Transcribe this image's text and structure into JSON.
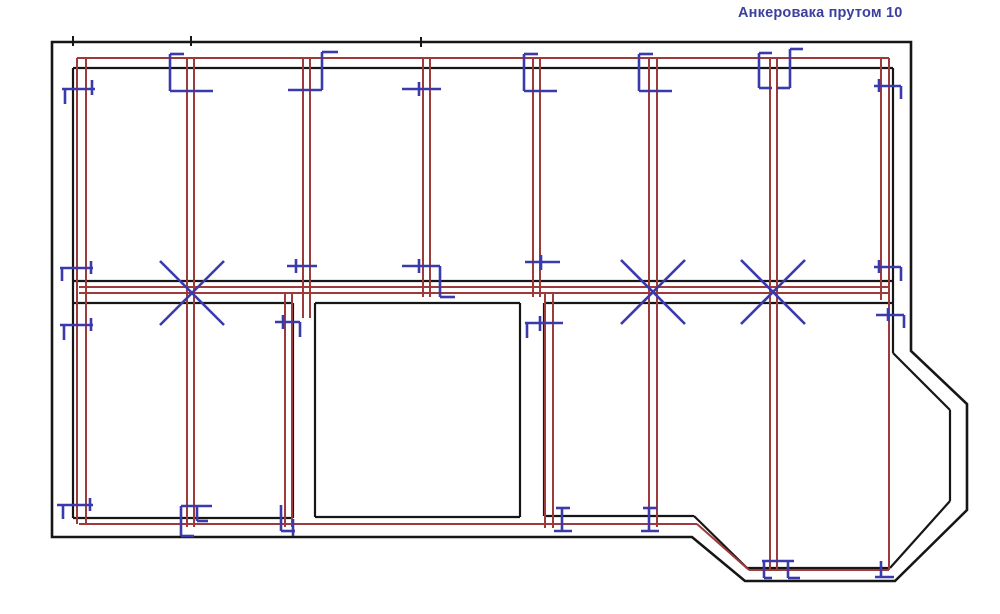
{
  "title": {
    "text": "Анкеровака прутом 10"
  },
  "palette": {
    "background": "#ffffff",
    "wall": "#161616",
    "rebar": "#9e3a3a",
    "anchor": "#3a3aad",
    "title_color": "#3b3f9e"
  },
  "plan": {
    "outer_wall_points": "52,42 911,42 911,351 967,404 967,510 895,581 745,581 692,537 52,537",
    "wall_lines": [
      [
        73,
        68,
        893,
        68
      ],
      [
        73,
        68,
        73,
        518
      ],
      [
        893,
        68,
        893,
        353
      ],
      [
        893,
        353,
        950,
        410
      ],
      [
        950,
        410,
        950,
        501
      ],
      [
        950,
        501,
        890,
        568
      ],
      [
        890,
        568,
        747,
        568
      ],
      [
        747,
        568,
        694,
        516
      ],
      [
        73,
        281,
        893,
        281
      ],
      [
        73,
        303,
        293,
        303
      ],
      [
        315,
        303,
        520,
        303
      ],
      [
        544,
        303,
        893,
        303
      ],
      [
        293,
        303,
        293,
        518
      ],
      [
        315,
        303,
        315,
        517
      ],
      [
        520,
        303,
        520,
        517
      ],
      [
        544,
        303,
        544,
        516
      ],
      [
        73,
        518,
        293,
        518
      ],
      [
        315,
        517,
        520,
        517
      ],
      [
        544,
        516,
        694,
        516
      ]
    ],
    "wall_ticks": [
      [
        73,
        36,
        73,
        46
      ],
      [
        191,
        36,
        191,
        46
      ],
      [
        421,
        37,
        421,
        47
      ]
    ],
    "rebar_lines": [
      [
        77,
        58,
        889,
        58
      ],
      [
        79,
        287,
        889,
        287
      ],
      [
        79,
        293,
        889,
        293
      ],
      [
        79,
        524,
        697,
        524
      ],
      [
        697,
        524,
        749,
        570
      ],
      [
        749,
        570,
        889,
        570
      ],
      [
        77,
        58,
        77,
        524
      ],
      [
        86,
        58,
        86,
        524
      ],
      [
        187,
        58,
        187,
        527
      ],
      [
        194,
        58,
        194,
        527
      ],
      [
        303,
        58,
        303,
        318
      ],
      [
        310,
        58,
        310,
        318
      ],
      [
        423,
        58,
        423,
        297
      ],
      [
        430,
        58,
        430,
        297
      ],
      [
        533,
        58,
        533,
        297
      ],
      [
        540,
        58,
        540,
        297
      ],
      [
        545,
        293,
        545,
        528
      ],
      [
        553,
        293,
        553,
        528
      ],
      [
        649,
        58,
        649,
        527
      ],
      [
        657,
        58,
        657,
        527
      ],
      [
        770,
        58,
        770,
        571
      ],
      [
        777,
        58,
        777,
        571
      ],
      [
        881,
        58,
        881,
        300
      ],
      [
        889,
        58,
        889,
        570
      ],
      [
        285,
        293,
        285,
        527
      ],
      [
        292,
        293,
        292,
        527
      ]
    ],
    "anchor_marks": [
      {
        "id": "top-left-corner",
        "segments": [
          [
            62,
            89,
            95,
            89
          ],
          [
            65,
            89,
            65,
            104
          ],
          [
            92,
            80,
            92,
            95
          ]
        ]
      },
      {
        "id": "p1-top-bracket",
        "segments": [
          [
            170,
            54,
            170,
            91
          ],
          [
            170,
            54,
            184,
            54
          ],
          [
            170,
            91,
            213,
            91
          ]
        ]
      },
      {
        "id": "p2-top-step",
        "segments": [
          [
            322,
            52,
            338,
            52
          ],
          [
            322,
            52,
            322,
            90
          ],
          [
            288,
            90,
            322,
            90
          ]
        ]
      },
      {
        "id": "p3-top-tick",
        "segments": [
          [
            402,
            89,
            441,
            89
          ],
          [
            419,
            82,
            419,
            96
          ]
        ]
      },
      {
        "id": "p4-top-bracket",
        "segments": [
          [
            524,
            54,
            524,
            91
          ],
          [
            524,
            54,
            538,
            54
          ],
          [
            524,
            91,
            557,
            91
          ]
        ]
      },
      {
        "id": "p5-top-bracket",
        "segments": [
          [
            639,
            54,
            639,
            91
          ],
          [
            639,
            54,
            653,
            54
          ],
          [
            639,
            91,
            672,
            91
          ]
        ]
      },
      {
        "id": "p6-top-double",
        "segments": [
          [
            759,
            53,
            759,
            88
          ],
          [
            759,
            53,
            772,
            53
          ],
          [
            759,
            88,
            772,
            88
          ],
          [
            790,
            49,
            790,
            88
          ],
          [
            790,
            49,
            803,
            49
          ],
          [
            777,
            88,
            790,
            88
          ]
        ]
      },
      {
        "id": "top-right-corner",
        "segments": [
          [
            874,
            86,
            901,
            86
          ],
          [
            901,
            86,
            901,
            99
          ],
          [
            879,
            79,
            879,
            92
          ]
        ]
      },
      {
        "id": "left-mid-upper",
        "segments": [
          [
            60,
            268,
            93,
            268
          ],
          [
            62,
            268,
            62,
            281
          ],
          [
            91,
            261,
            91,
            274
          ]
        ]
      },
      {
        "id": "left-mid-lower",
        "segments": [
          [
            60,
            325,
            93,
            325
          ],
          [
            64,
            325,
            64,
            340
          ],
          [
            91,
            318,
            91,
            331
          ]
        ]
      },
      {
        "id": "p2-mid-tick",
        "segments": [
          [
            287,
            266,
            317,
            266
          ],
          [
            296,
            259,
            296,
            273
          ]
        ]
      },
      {
        "id": "p3-mid-hook",
        "segments": [
          [
            402,
            266,
            440,
            266
          ],
          [
            419,
            259,
            419,
            273
          ],
          [
            440,
            266,
            440,
            297
          ],
          [
            440,
            297,
            455,
            297
          ]
        ]
      },
      {
        "id": "p4-mid-tick",
        "segments": [
          [
            525,
            262,
            560,
            262
          ],
          [
            541,
            255,
            541,
            270
          ]
        ]
      },
      {
        "id": "right-mid-tick",
        "segments": [
          [
            874,
            267,
            901,
            267
          ],
          [
            901,
            267,
            901,
            281
          ],
          [
            879,
            260,
            879,
            273
          ]
        ]
      },
      {
        "id": "room1-topright-hook",
        "segments": [
          [
            275,
            322,
            300,
            322
          ],
          [
            300,
            322,
            300,
            337
          ],
          [
            283,
            315,
            283,
            329
          ]
        ]
      },
      {
        "id": "room3-topleft-hook",
        "segments": [
          [
            525,
            323,
            563,
            323
          ],
          [
            527,
            323,
            527,
            338
          ],
          [
            540,
            316,
            540,
            331
          ]
        ]
      },
      {
        "id": "right-lower-tick",
        "segments": [
          [
            876,
            315,
            904,
            315
          ],
          [
            904,
            315,
            904,
            328
          ],
          [
            888,
            308,
            888,
            321
          ]
        ]
      },
      {
        "id": "room1-bottomleft",
        "segments": [
          [
            57,
            505,
            93,
            505
          ],
          [
            63,
            505,
            63,
            519
          ],
          [
            90,
            498,
            90,
            511
          ]
        ]
      },
      {
        "id": "room1-bottom-bracket",
        "segments": [
          [
            181,
            506,
            212,
            506
          ],
          [
            181,
            506,
            181,
            536
          ],
          [
            181,
            536,
            194,
            536
          ],
          [
            197,
            506,
            197,
            521
          ],
          [
            197,
            521,
            208,
            521
          ]
        ]
      },
      {
        "id": "room1-bottomright",
        "segments": [
          [
            281,
            505,
            281,
            531
          ],
          [
            281,
            531,
            295,
            531
          ],
          [
            293,
            519,
            293,
            536
          ]
        ]
      },
      {
        "id": "room3-bottom-tee-1",
        "segments": [
          [
            556,
            508,
            570,
            508
          ],
          [
            562,
            508,
            562,
            531
          ],
          [
            554,
            531,
            572,
            531
          ]
        ]
      },
      {
        "id": "room3-bottom-tee-2",
        "segments": [
          [
            643,
            508,
            657,
            508
          ],
          [
            649,
            508,
            649,
            531
          ],
          [
            641,
            531,
            659,
            531
          ]
        ]
      },
      {
        "id": "bay-bottom-bracket",
        "segments": [
          [
            762,
            561,
            794,
            561
          ],
          [
            764,
            561,
            764,
            578
          ],
          [
            764,
            578,
            772,
            578
          ],
          [
            788,
            561,
            788,
            578
          ],
          [
            788,
            578,
            800,
            578
          ]
        ]
      },
      {
        "id": "bay-bottomright-hook",
        "segments": [
          [
            881,
            561,
            881,
            577
          ],
          [
            875,
            577,
            894,
            577
          ]
        ]
      }
    ],
    "crosses": [
      {
        "cx": 192,
        "cy": 293,
        "arm": 32
      },
      {
        "cx": 653,
        "cy": 292,
        "arm": 32
      },
      {
        "cx": 773,
        "cy": 292,
        "arm": 32
      }
    ]
  }
}
